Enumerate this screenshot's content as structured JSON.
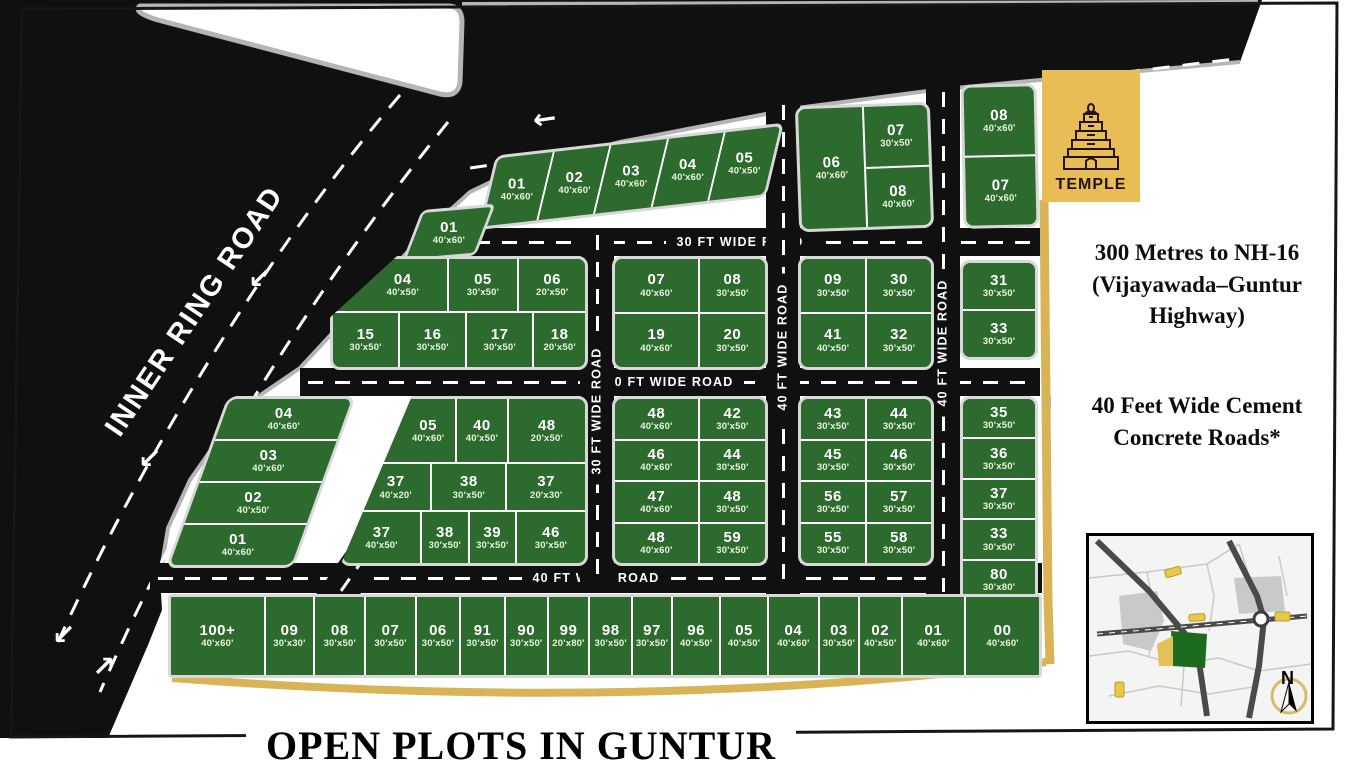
{
  "title": "OPEN PLOTS IN GUNTUR",
  "temple": {
    "label": "TEMPLE"
  },
  "info": {
    "line1": "300 Metres to NH-16 (Vijayawada–Guntur Highway)",
    "line2": "40 Feet Wide Cement Concrete Roads*"
  },
  "roads": {
    "inner_ring": "INNER RING ROAD",
    "h1": "30 FT WIDE ROAD",
    "h2": "30 FT WIDE ROAD",
    "h3": "40 FT WIDE ROAD",
    "v1": "30 FT WIDE ROAD",
    "v2": "40 FT WIDE ROAD",
    "v3": "40 FT WIDE ROAD",
    "diag": "30 FT WIDE ROAD"
  },
  "compass": "N",
  "colors": {
    "plot_green": "#2d6a2e",
    "road_black": "#101010",
    "gold_accent": "#d9b457",
    "temple_gold": "#e8bd55",
    "curb_gray": "#b5b5b5"
  },
  "blocks": {
    "top_strip": [
      {
        "n": "01",
        "s": "40'x60'"
      },
      {
        "n": "02",
        "s": "40'x60'"
      },
      {
        "n": "03",
        "s": "40'x60'"
      },
      {
        "n": "04",
        "s": "40'x60'"
      },
      {
        "n": "05",
        "s": "40'x50'"
      }
    ],
    "corner_plot": {
      "n": "01",
      "s": "40'x60'"
    },
    "temple_a": {
      "left": {
        "n": "06",
        "s": "40'x60'"
      },
      "right_top": {
        "n": "07",
        "s": "30'x50'"
      },
      "right_bottom": {
        "n": "08",
        "s": "40'x60'"
      }
    },
    "temple_b": [
      {
        "n": "08",
        "s": "40'x60'"
      },
      {
        "n": "07",
        "s": "40'x60'"
      }
    ],
    "row2_left": [
      [
        {
          "n": "04",
          "s": "40'x50'"
        },
        {
          "n": "05",
          "s": "30'x50'"
        },
        {
          "n": "06",
          "s": "20'x50'"
        }
      ],
      [
        {
          "n": "15",
          "s": "30'x50'"
        },
        {
          "n": "16",
          "s": "30'x50'"
        },
        {
          "n": "17",
          "s": "30'x50'"
        },
        {
          "n": "18",
          "s": "20'x50'"
        }
      ]
    ],
    "row2_mid": [
      [
        {
          "n": "07",
          "s": "40'x60'"
        },
        {
          "n": "08",
          "s": "30'x50'"
        }
      ],
      [
        {
          "n": "19",
          "s": "40'x60'"
        },
        {
          "n": "20",
          "s": "30'x50'"
        }
      ]
    ],
    "row2_right": [
      [
        {
          "n": "09",
          "s": "30'x50'"
        },
        {
          "n": "30",
          "s": "30'x50'"
        }
      ],
      [
        {
          "n": "41",
          "s": "40'x50'"
        },
        {
          "n": "32",
          "s": "30'x50'"
        }
      ]
    ],
    "row2_far": [
      {
        "n": "31",
        "s": "30'x50'"
      },
      {
        "n": "33",
        "s": "30'x50'"
      }
    ],
    "row3_left": [
      {
        "n": "04",
        "s": "40'x60'"
      },
      {
        "n": "03",
        "s": "40'x60'"
      },
      {
        "n": "02",
        "s": "40'x50'"
      },
      {
        "n": "01",
        "s": "40'x60'"
      }
    ],
    "row3_midleft": [
      [
        {
          "n": "05",
          "s": "40'x60'"
        },
        {
          "n": "40",
          "s": "40'x50'"
        },
        {
          "n": "48",
          "s": "20'x50'"
        }
      ],
      [
        {
          "n": "37",
          "s": "40'x20'"
        },
        {
          "n": "38",
          "s": "30'x50'"
        },
        {
          "n": "37",
          "s": "20'x30'"
        }
      ],
      [
        {
          "n": "37",
          "s": "40'x50'"
        },
        {
          "n": "38",
          "s": "30'x50'"
        },
        {
          "n": "39",
          "s": "30'x50'"
        },
        {
          "n": "46",
          "s": "30'x50'"
        }
      ]
    ],
    "row3_mid": [
      [
        {
          "n": "48",
          "s": "40'x60'"
        },
        {
          "n": "42",
          "s": "30'x50'"
        }
      ],
      [
        {
          "n": "46",
          "s": "40'x60'"
        },
        {
          "n": "44",
          "s": "30'x50'"
        }
      ],
      [
        {
          "n": "47",
          "s": "40'x60'"
        },
        {
          "n": "48",
          "s": "30'x50'"
        }
      ],
      [
        {
          "n": "48",
          "s": "40'x60'"
        },
        {
          "n": "59",
          "s": "30'x50'"
        }
      ]
    ],
    "row3_right": [
      [
        {
          "n": "43",
          "s": "30'x50'"
        },
        {
          "n": "44",
          "s": "30'x50'"
        }
      ],
      [
        {
          "n": "45",
          "s": "30'x50'"
        },
        {
          "n": "46",
          "s": "30'x50'"
        }
      ],
      [
        {
          "n": "56",
          "s": "30'x50'"
        },
        {
          "n": "57",
          "s": "30'x50'"
        }
      ],
      [
        {
          "n": "55",
          "s": "30'x50'"
        },
        {
          "n": "58",
          "s": "30'x50'"
        }
      ]
    ],
    "row3_far": [
      {
        "n": "35",
        "s": "30'x50'"
      },
      {
        "n": "36",
        "s": "30'x50'"
      },
      {
        "n": "37",
        "s": "30'x50'"
      },
      {
        "n": "33",
        "s": "30'x50'"
      },
      {
        "n": "80",
        "s": "30'x80'"
      }
    ],
    "bottom_strip": [
      {
        "n": "100+",
        "s": "40'x60'"
      },
      {
        "n": "09",
        "s": "30'x30'"
      },
      {
        "n": "08",
        "s": "30'x50'"
      },
      {
        "n": "07",
        "s": "30'x50'"
      },
      {
        "n": "06",
        "s": "30'x50'"
      },
      {
        "n": "91",
        "s": "30'x50'"
      },
      {
        "n": "90",
        "s": "30'x50'"
      },
      {
        "n": "99",
        "s": "20'x80'"
      },
      {
        "n": "98",
        "s": "30'x50'"
      },
      {
        "n": "97",
        "s": "30'x50'"
      },
      {
        "n": "96",
        "s": "40'x50'"
      },
      {
        "n": "05",
        "s": "40'x50'"
      },
      {
        "n": "04",
        "s": "40'x60'"
      },
      {
        "n": "03",
        "s": "30'x50'"
      },
      {
        "n": "02",
        "s": "40'x50'"
      },
      {
        "n": "01",
        "s": "40'x60'"
      },
      {
        "n": "00",
        "s": "40'x60'"
      }
    ]
  }
}
